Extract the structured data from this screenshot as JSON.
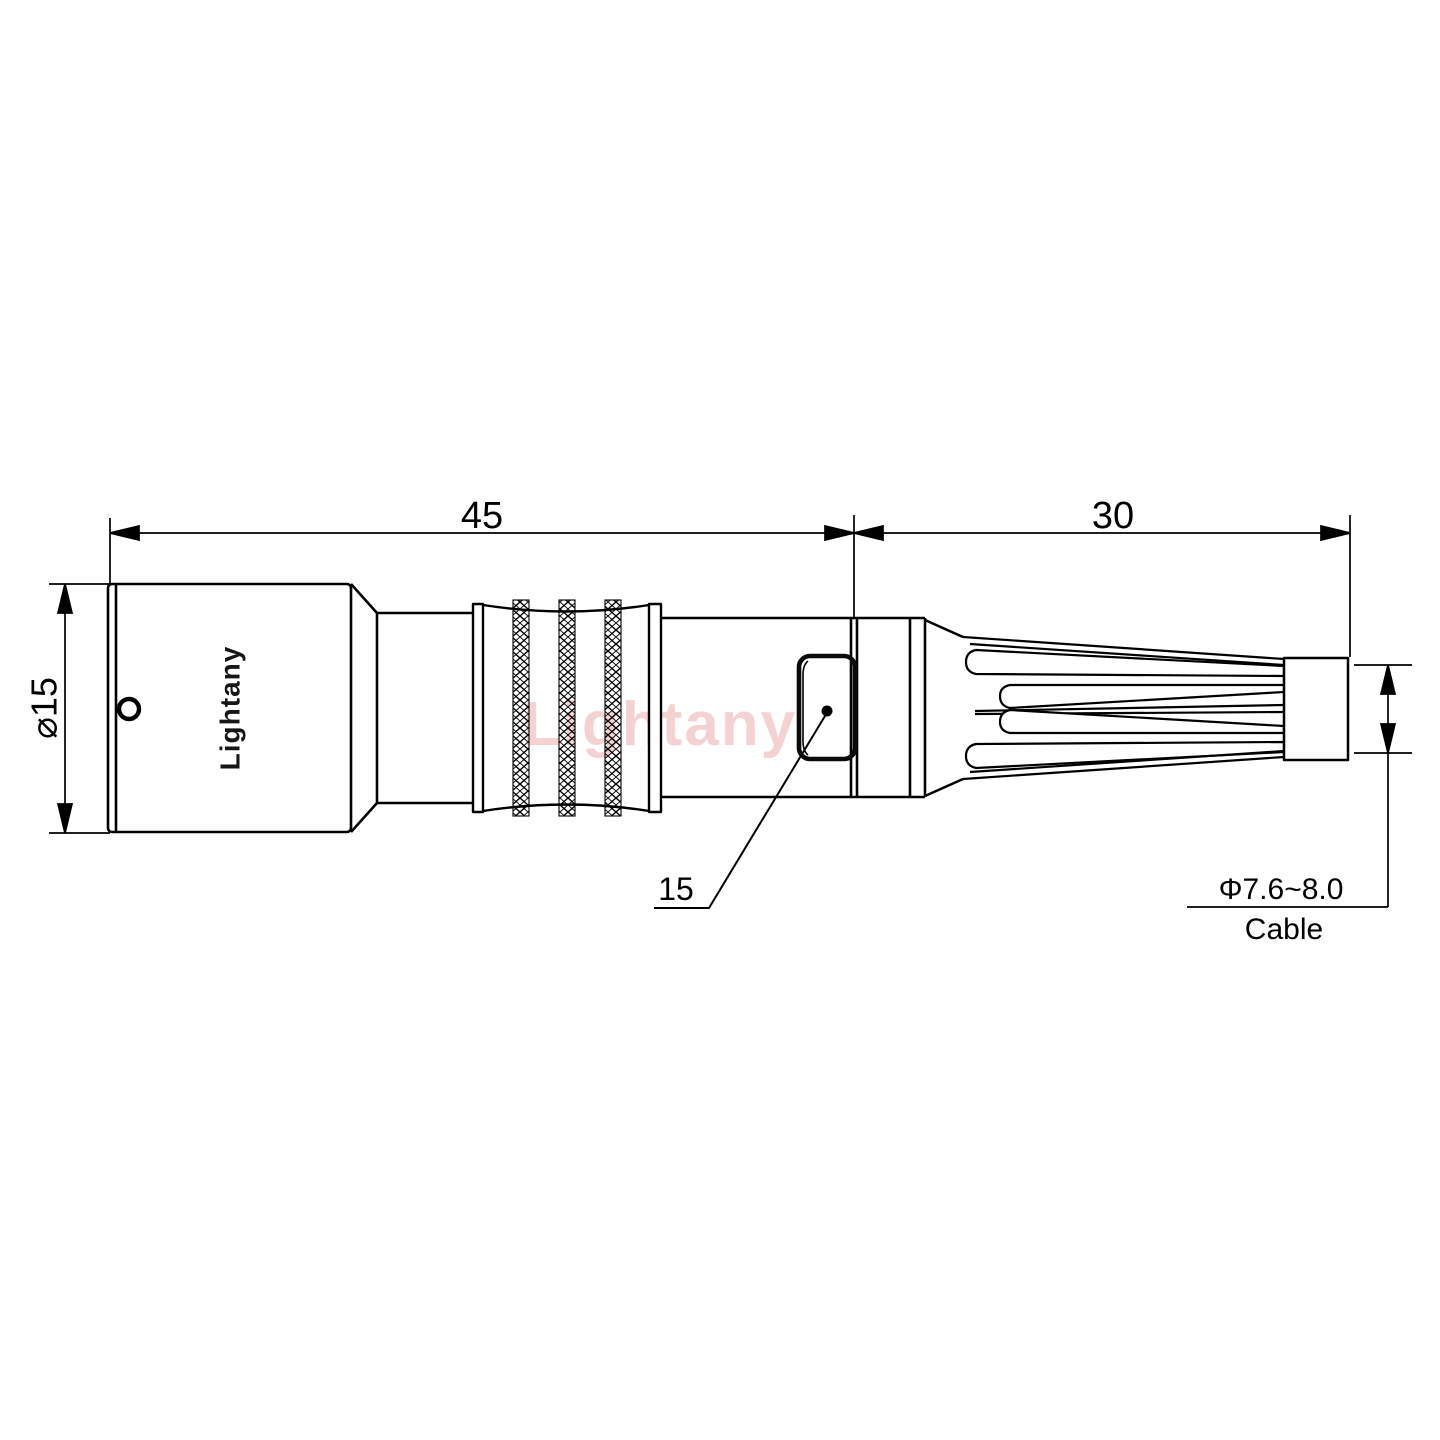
{
  "drawing": {
    "type": "technical-connector-drawing",
    "dimensions": {
      "front_length": "45",
      "rear_length": "30",
      "body_diameter": "⌀15",
      "latch_callout": "15",
      "cable_diameter_range": "Φ7.6~8.0",
      "cable_label": "Cable"
    },
    "branding": {
      "body_label": "Lightany",
      "watermark": "Lightany"
    },
    "colors": {
      "line": "#000000",
      "background": "#ffffff",
      "watermark_pink": "#e79595"
    }
  }
}
